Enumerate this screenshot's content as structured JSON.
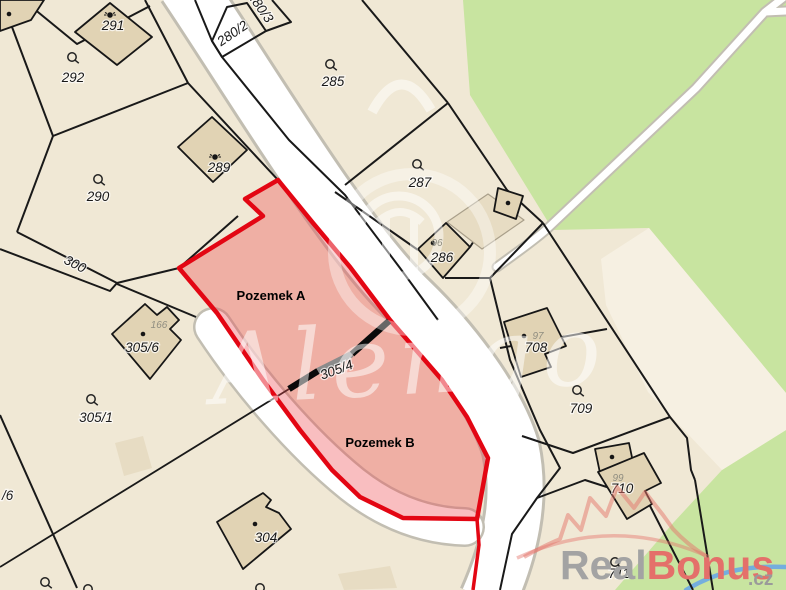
{
  "map": {
    "watermark_text": "Alengo",
    "highlight": {
      "label_a": "Pozemek A",
      "label_b": "Pozemek B",
      "outline_color": "#e30613",
      "fill_color": "rgba(237,68,74,0.35)"
    },
    "parcel_labels": [
      {
        "text": "291"
      },
      {
        "text": "292"
      },
      {
        "text": "290"
      },
      {
        "text": "289"
      },
      {
        "text": "285"
      },
      {
        "text": "287"
      },
      {
        "text": "286"
      },
      {
        "text": "280/2"
      },
      {
        "text": "280/3"
      },
      {
        "text": "300"
      },
      {
        "text": "305/6"
      },
      {
        "text": "305/1"
      },
      {
        "text": "305/4"
      },
      {
        "text": "304"
      },
      {
        "text": "708"
      },
      {
        "text": "709"
      },
      {
        "text": "710"
      },
      {
        "text": "711"
      },
      {
        "text": "/6"
      }
    ],
    "gray_labels": [
      {
        "text": "166"
      },
      {
        "text": "96"
      },
      {
        "text": "97"
      },
      {
        "text": "99"
      }
    ],
    "colors": {
      "base_beige": "#f0e8d5",
      "green_area": "#c8e4a0",
      "light_zone": "#f6f0e2",
      "road_fill": "#ffffff",
      "road_casing": "#c2beb2",
      "parcel_line": "#191919",
      "building_fill": "#e1d3b4",
      "building_light_fill": "#e7dcc3",
      "divider_black": "#0a0a0a",
      "divider_gray": "#8b8b8b",
      "stream_blue": "#74aede",
      "crown_watermark": "rgba(228,118,108,0.5)"
    }
  },
  "branding": {
    "logo_gray": "Real",
    "logo_red": "Bonus",
    "logo_tld": ".cz"
  }
}
